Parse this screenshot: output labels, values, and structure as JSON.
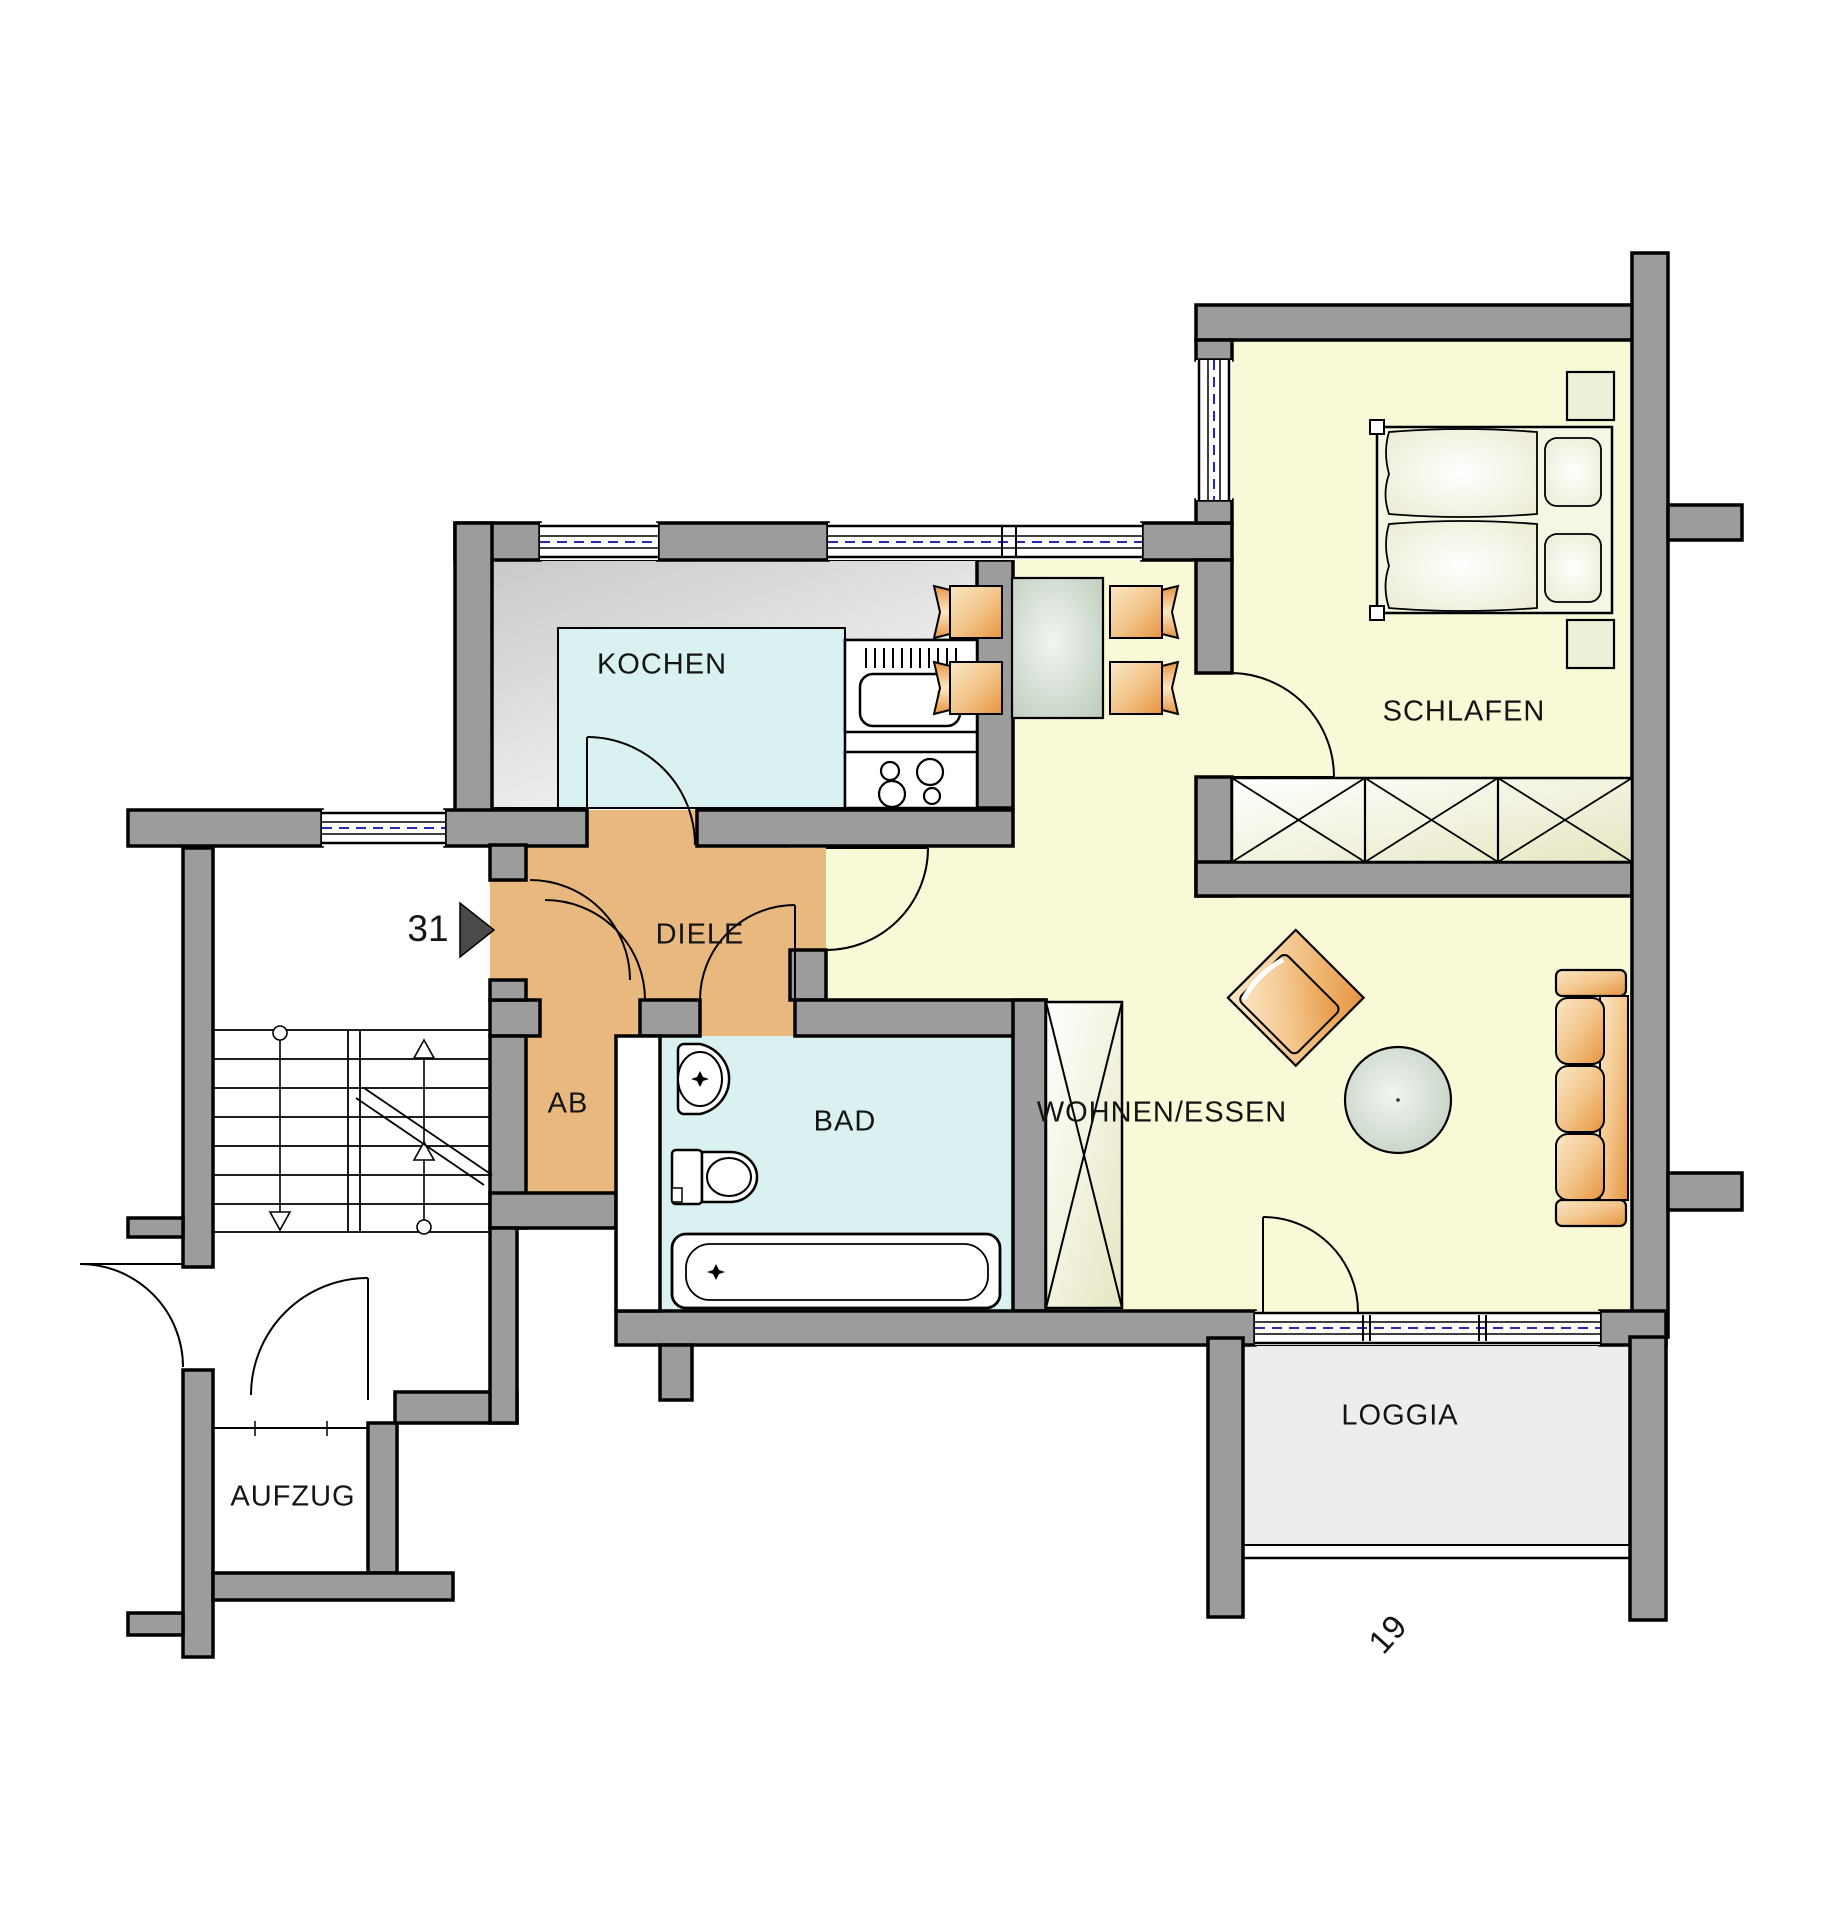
{
  "rooms": {
    "kochen": {
      "label": "KOCHEN"
    },
    "diele": {
      "label": "DIELE"
    },
    "ab": {
      "label": "AB"
    },
    "bad": {
      "label": "BAD"
    },
    "wohnen_essen": {
      "label": "WOHNEN/ESSEN"
    },
    "schlafen": {
      "label": "SCHLAFEN"
    },
    "loggia": {
      "label": "LOGGIA"
    },
    "aufzug": {
      "label": "AUFZUG"
    }
  },
  "markers": {
    "unit_number": "31",
    "plan_number": "19"
  },
  "colors": {
    "wall_fill": "#9c9c9c",
    "outline": "#000000",
    "floor_living": "#f9f9d8",
    "floor_hall": "#e9b87e",
    "floor_wet": "#d9f1f1",
    "floor_loggia": "#ededed",
    "kitchen_floor": "#d8d8d8",
    "furniture_accent": "#e89b50",
    "cabinet_cream": "#eeeecf",
    "glazing_dash": "#2929b8"
  }
}
